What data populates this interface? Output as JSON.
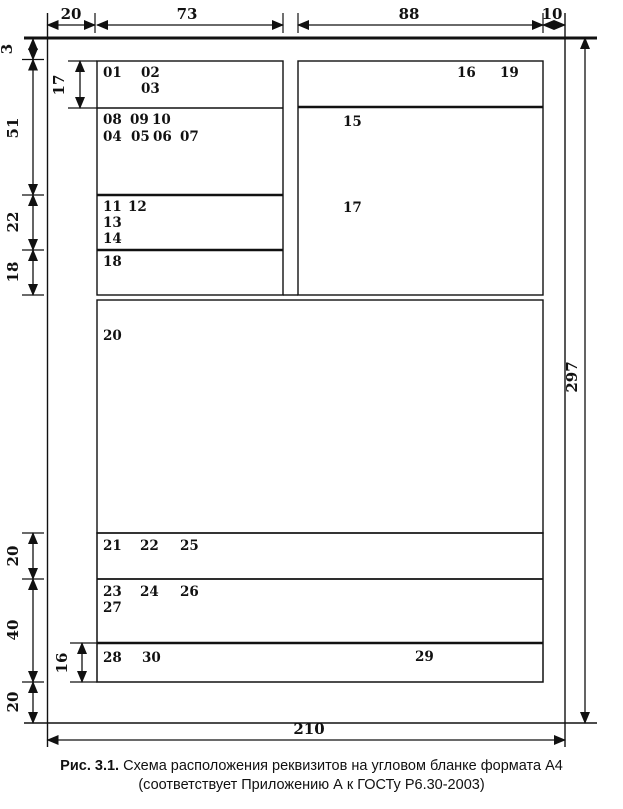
{
  "dimensions": {
    "top": {
      "left_margin": "20",
      "left_block_width": "73",
      "right_block_width": "88",
      "right_margin": "10"
    },
    "left": {
      "top_offset": "3",
      "header_zone": "51",
      "zone_22": "22",
      "zone_18": "18",
      "zone_20a": "20",
      "zone_40": "40",
      "bottom_margin": "20"
    },
    "inner": {
      "emblem_height": "17",
      "footer_height": "16"
    },
    "page": {
      "height": "297",
      "width": "210"
    }
  },
  "requisites": {
    "r01": "01",
    "r02": "02",
    "r03": "03",
    "r04": "04",
    "r05": "05",
    "r06": "06",
    "r07": "07",
    "r08": "08",
    "r09": "09",
    "r10": "10",
    "r11": "11",
    "r12": "12",
    "r13": "13",
    "r14": "14",
    "r15": "15",
    "r16": "16",
    "r17": "17",
    "r18": "18",
    "r19": "19",
    "r20": "20",
    "r21": "21",
    "r22": "22",
    "r23": "23",
    "r24": "24",
    "r25": "25",
    "r26": "26",
    "r27": "27",
    "r28": "28",
    "r29": "29",
    "r30": "30"
  },
  "caption": {
    "prefix": "Рис. 3.1.",
    "line1": " Схема расположения реквизитов на угловом бланке формата А4",
    "line2": "(соответствует Приложению А к ГОСТу Р6.30-2003)"
  }
}
